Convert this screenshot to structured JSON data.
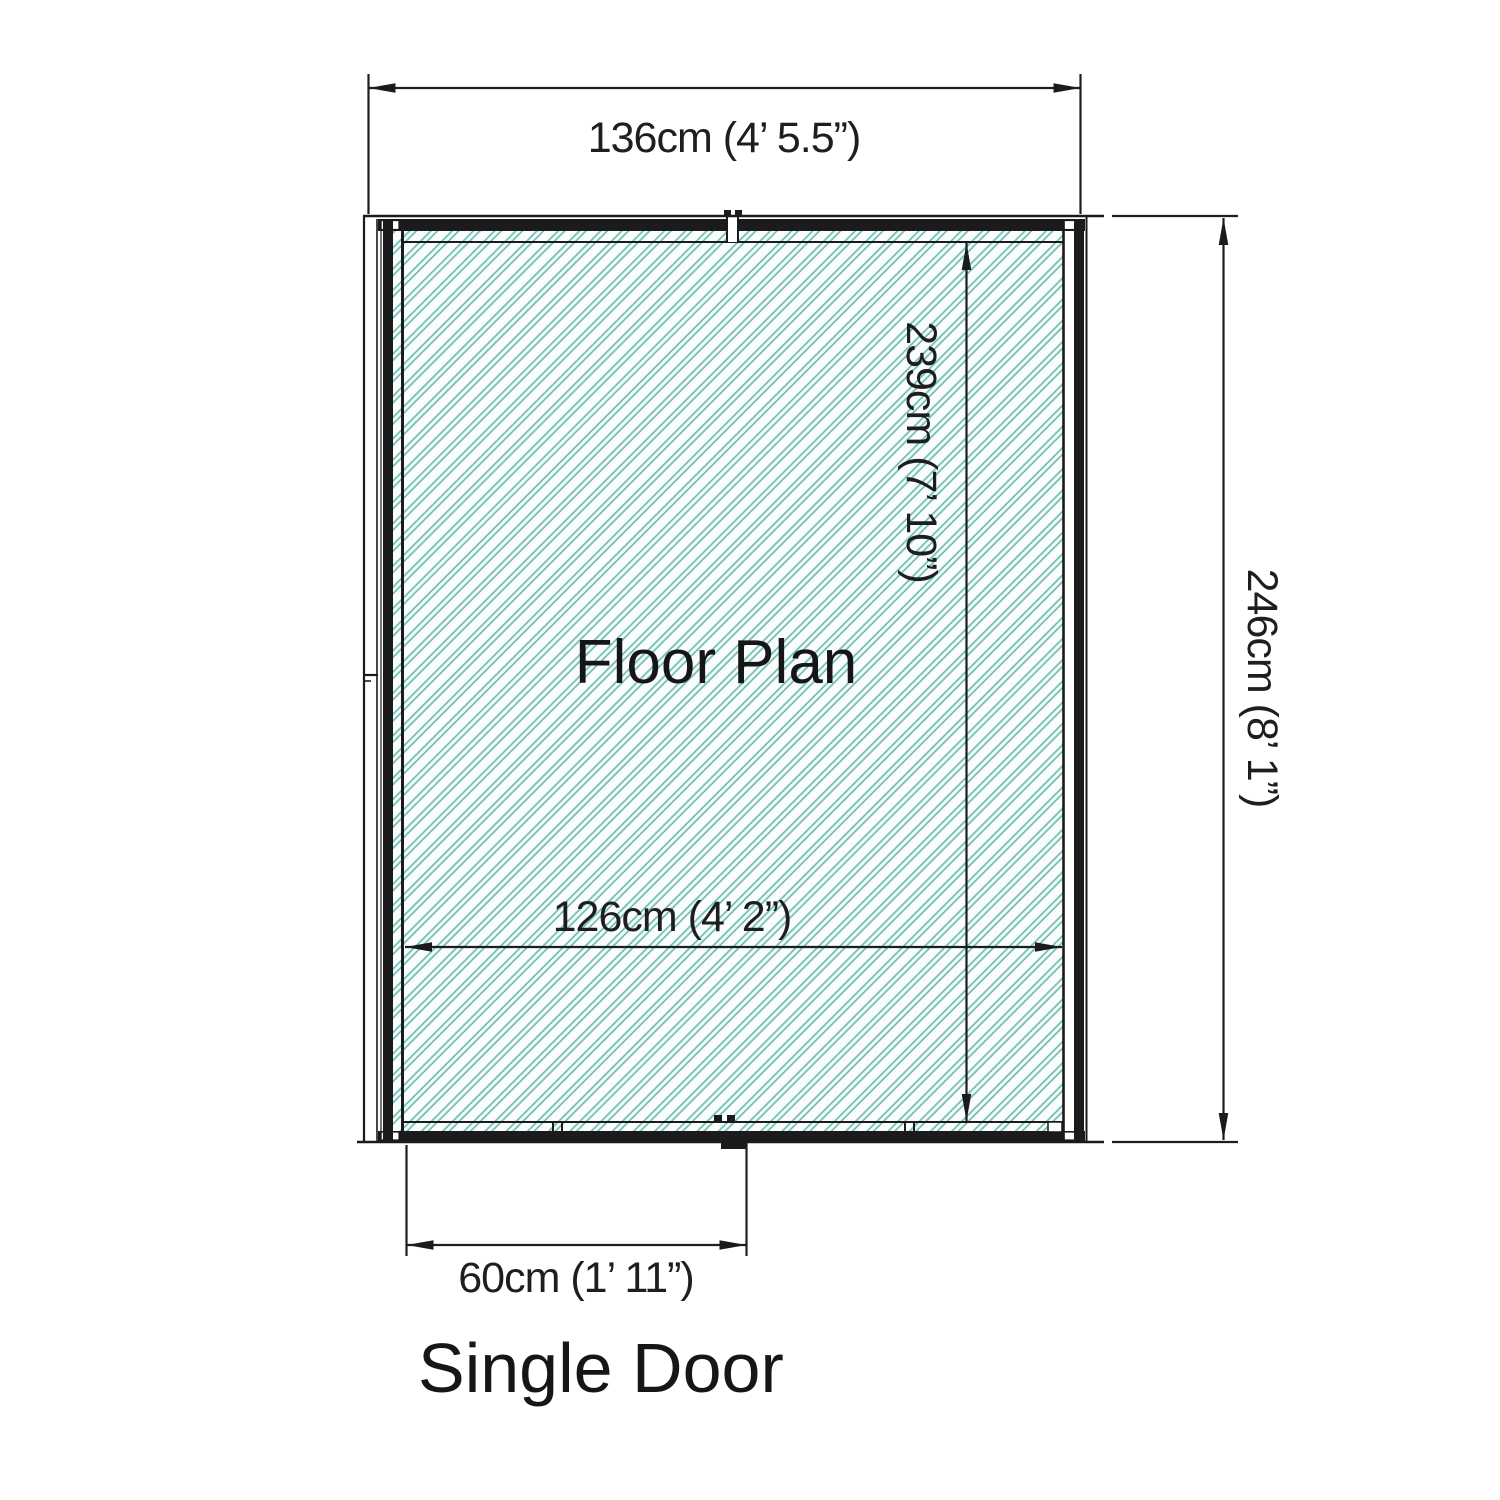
{
  "diagram": {
    "floor_plan_label": "Floor Plan",
    "caption": "Single Door",
    "dimensions": {
      "outer_width": "136cm (4’ 5.5”)",
      "outer_height": "246cm (8’ 1”)",
      "inner_height": "239cm (7’ 10”)",
      "inner_width": "126cm (4’ 2”)",
      "door_width": "60cm (1’ 11”)"
    },
    "colors": {
      "hatch_line": "#6cc0b4",
      "hatch_bg": "#fbfdfd",
      "draw_line": "#1b1b1b"
    }
  }
}
